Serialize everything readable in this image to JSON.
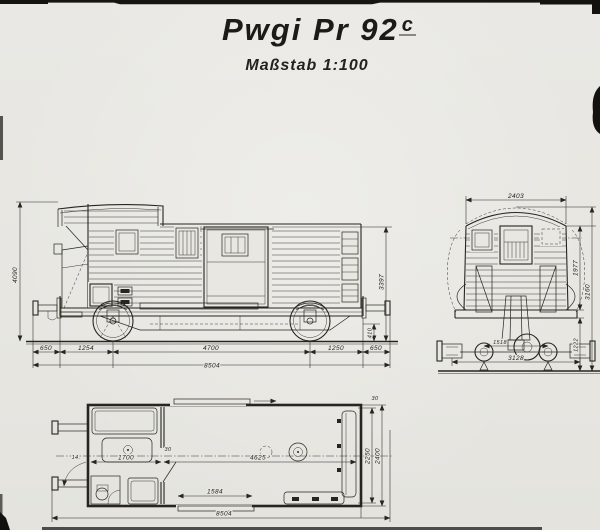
{
  "drawing": {
    "title": "Pwgi Pr 92",
    "title_sup": "c",
    "scale_label": "Maßstab 1:100",
    "ink_color": "#27251f",
    "paper_color": "#e8e7e2"
  },
  "side_view": {
    "dim_height_left": "4090",
    "dim_height_right": "3397",
    "dim_buffer_height": "410",
    "dim_overhang_left": "650",
    "dim_axle_left": "1254",
    "dim_wheelbase": "4700",
    "dim_axle_right": "1250",
    "dim_overhang_right": "650",
    "dim_total_length": "8504"
  },
  "end_view": {
    "dim_roof_width": "2403",
    "dim_wall_height": "1977",
    "dim_overall_height": "3160",
    "dim_frame_height": "1222",
    "dim_rail_gauge": "1518",
    "dim_overall_width": "3128"
  },
  "plan_view": {
    "dim_compartment": "1700",
    "dim_partition": "30",
    "dim_luggage_room": "4625",
    "dim_door_opening": "1584",
    "dim_total_length": "8504",
    "dim_inner_width": "2250",
    "dim_outer_width": "2400",
    "dim_wall_top": "30",
    "door_label": "14."
  }
}
